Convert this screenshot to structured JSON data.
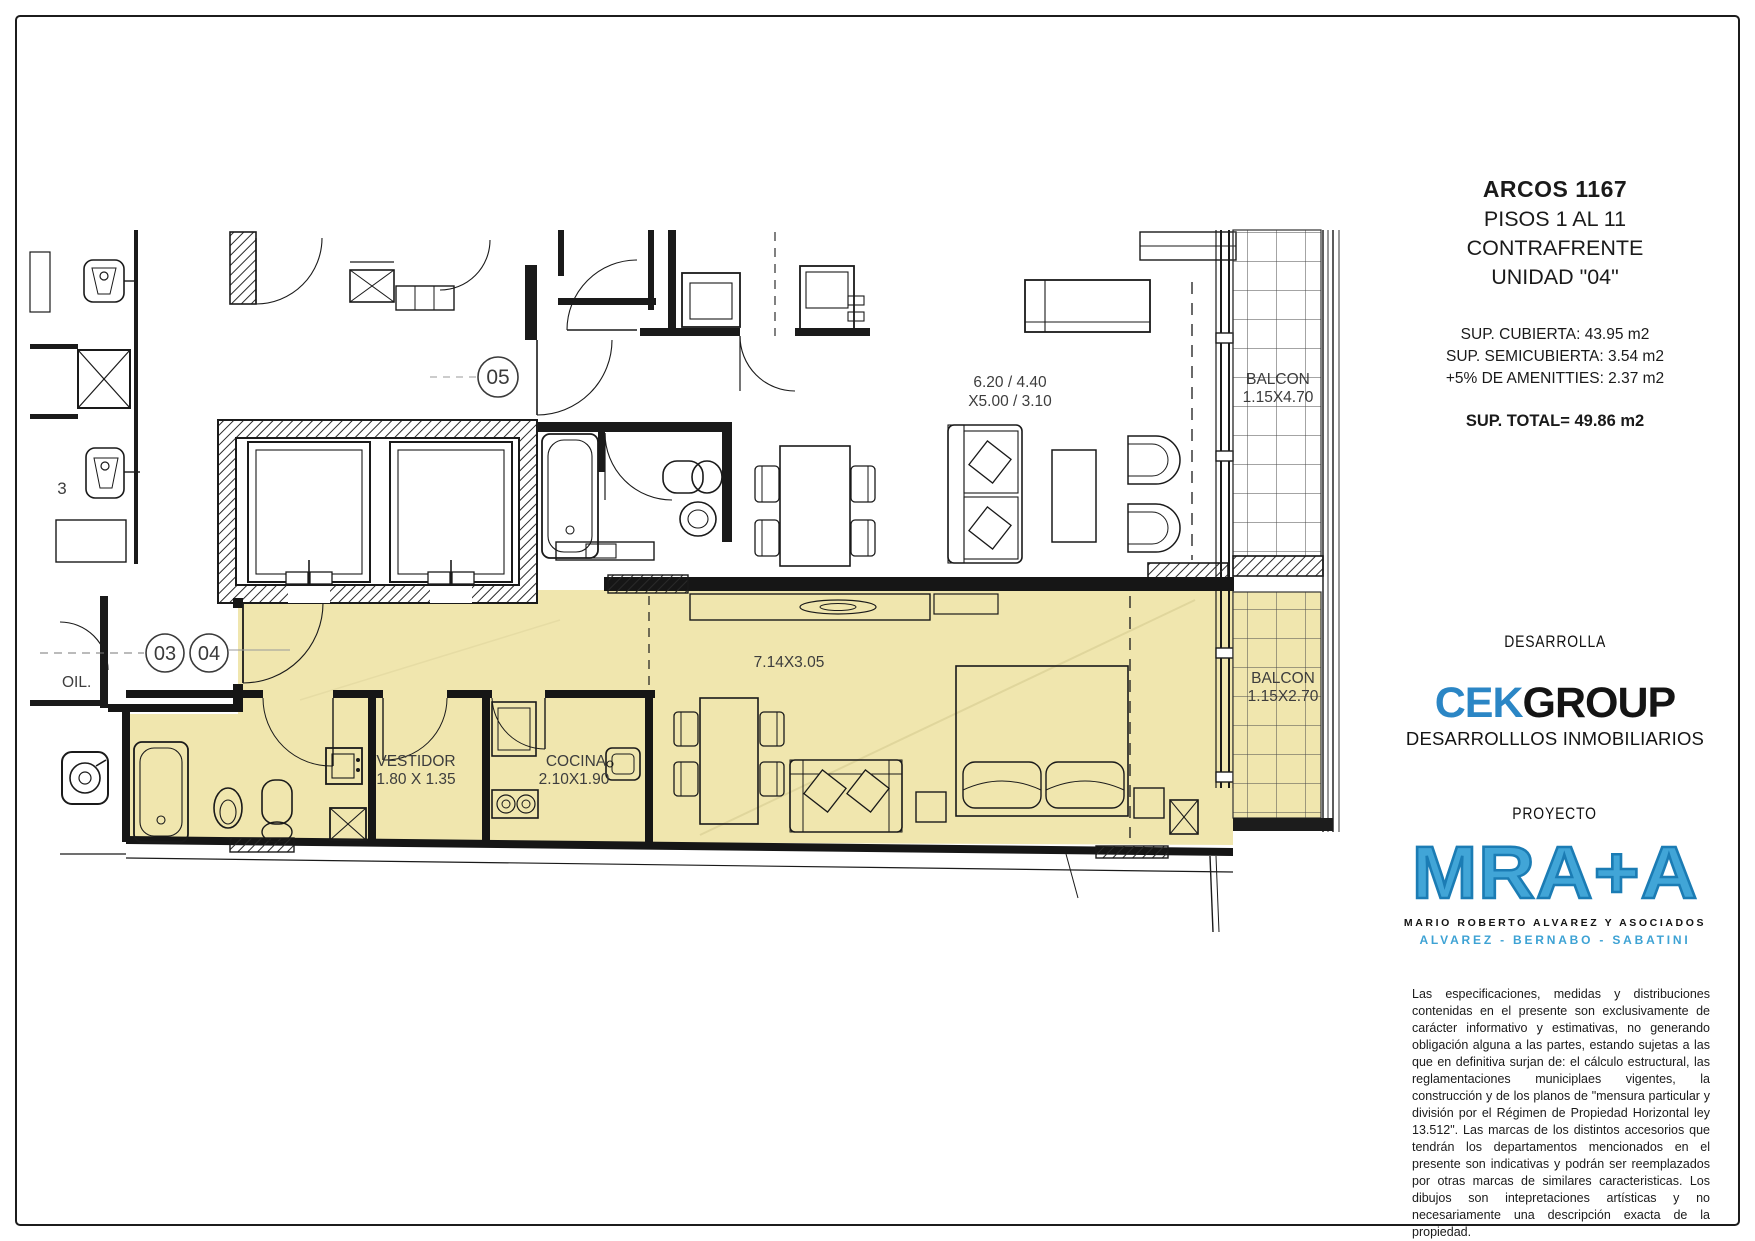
{
  "page": {
    "background": "#ffffff",
    "border_color": "#1c1c1c"
  },
  "title_block": {
    "project": "ARCOS 1167",
    "floors": "PISOS 1 AL 11",
    "orientation": "CONTRAFRENTE",
    "unit": "UNIDAD \"04\"",
    "areas": {
      "covered": "SUP. CUBIERTA: 43.95 m2",
      "semicovered": "SUP. SEMICUBIERTA: 3.54 m2",
      "amenities": "+5% DE AMENITTIES: 2.37 m2",
      "total": "SUP. TOTAL= 49.86 m2"
    },
    "developer_label": "DESARROLLA",
    "developer_logo": {
      "part1": "CEK",
      "part2": "GROUP",
      "subtitle": "DESARROLLLOS INMOBILIARIOS",
      "accent_color": "#2b86c5"
    },
    "architect_label": "PROYECTO",
    "architect_logo": {
      "text": "MRA+A",
      "line1": "MARIO ROBERTO ALVAREZ Y ASOCIADOS",
      "line2": "ALVAREZ - BERNABO - SABATINI",
      "color": "#41a5d7"
    },
    "disclaimer": "Las especificaciones, medidas y distribuciones contenidas en el presente son exclusivamente de carácter informativo y estimativas, no generando obligación alguna a las partes, estando sujetas a las que en definitiva surjan de: el cálculo estructural, las reglamentaciones municiplaes vigentes, la construcción y de los planos de \"mensura particular y división por el Régimen de Propiedad Horizontal ley 13.512\". Las marcas de los distintos accesorios que tendrán los departamentos mencionados en el presente son indicativas y podrán ser reemplazados por otras marcas de similares caracteristicas. Los dibujos son intepretaciones artísticas y no necesariamente una descripción exacta de la propiedad."
  },
  "plan": {
    "unit_fill": "#f0e6ae",
    "labels": {
      "circle_05": "05",
      "circle_03": "03",
      "circle_04": "04",
      "upper_dims_line1": "6.20 / 4.40",
      "upper_dims_line2": "X5.00 / 3.10",
      "balcony_upper_line1": "BALCON",
      "balcony_upper_line2": "1.15X4.70",
      "living_dims": "7.14X3.05",
      "vestidor_line1": "VESTIDOR",
      "vestidor_line2": "1.80 X 1.35",
      "cocina_line1": "COCINA",
      "cocina_line2": "2.10X1.90",
      "balcony_lower_line1": "BALCON",
      "balcony_lower_line2": "1.15X2.70",
      "left_partial_label": "OIL.",
      "left_partial_number": "3"
    }
  }
}
